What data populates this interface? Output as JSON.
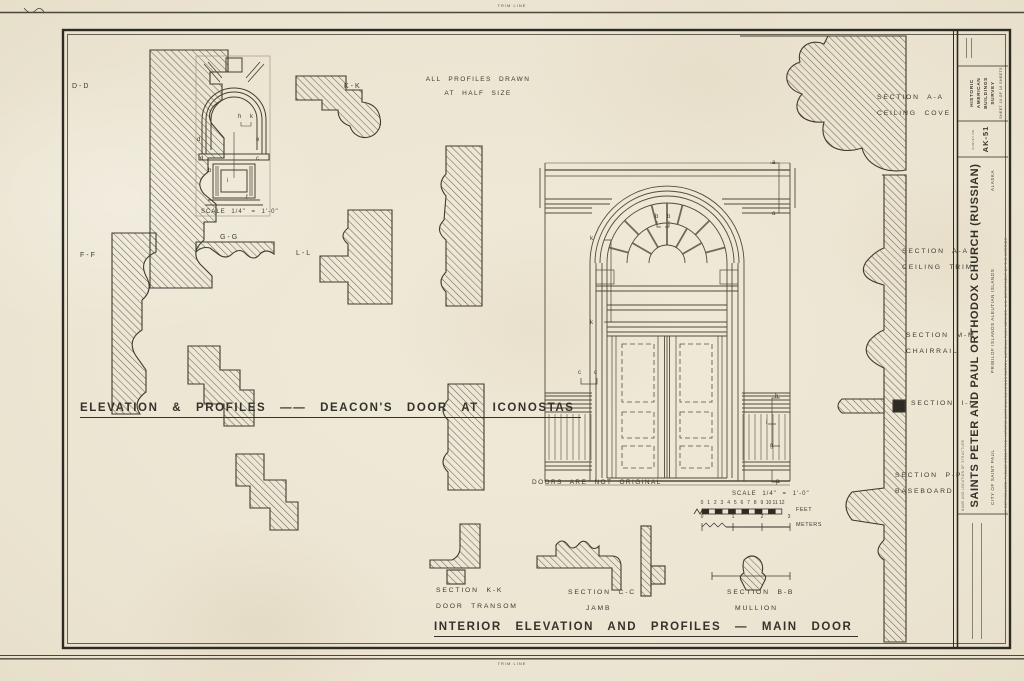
{
  "sheet": {
    "trim_line": "TRIM LINE"
  },
  "notes": {
    "profiles_note_1": "ALL PROFILES DRAWN",
    "profiles_note_2": "AT HALF SIZE",
    "doors_note": "DOORS ARE NOT ORIGINAL"
  },
  "profile_labels": {
    "dd": "D-D",
    "kk": "K-K",
    "ff": "F-F",
    "gg": "G-G",
    "ll": "L-L"
  },
  "titles": {
    "left": "ELEVATION & PROFILES —— DEACON'S DOOR AT ICONOSTAS",
    "main": "INTERIOR ELEVATION AND PROFILES — MAIN DOOR"
  },
  "scales": {
    "plan_scale": "SCALE  1/4\" = 1'-0\"",
    "main_scale": "SCALE  1/4\" = 1'-0\"",
    "feet_unit": "FEET",
    "meters_unit": "METERS",
    "feet_ticks": [
      "0",
      "1",
      "2",
      "3",
      "4",
      "5",
      "6",
      "7",
      "8",
      "9",
      "10",
      "11",
      "12"
    ],
    "meters_ticks": [
      {
        "label": "0",
        "x": 699
      },
      {
        "label": "1",
        "x": 730
      },
      {
        "label": "2",
        "x": 759
      },
      {
        "label": "3",
        "x": 786
      }
    ]
  },
  "sections": [
    {
      "line1": "SECTION  A-A",
      "line2": "CEILING  COVE"
    },
    {
      "line1": "SECTION  A-A",
      "line2": "CEILING  TRIM"
    },
    {
      "line1": "SECTION  M-M",
      "line2": "CHAIRRAIL"
    },
    {
      "line1": "SECTION  I-I",
      "line2": ""
    },
    {
      "line1": "SECTION  P-P",
      "line2": "BASEBOARD"
    },
    {
      "line1": "SECTION  K-K",
      "line2": "DOOR  TRANSOM"
    },
    {
      "line1": "SECTION  C-C",
      "line2": "JAMB"
    },
    {
      "line1": "SECTION  B-B",
      "line2": "MULLION"
    }
  ],
  "ref_letters": {
    "plan": [
      {
        "char": "h",
        "x": 238,
        "y": 114
      },
      {
        "char": "k",
        "x": 250,
        "y": 114
      },
      {
        "char": "d",
        "x": 197,
        "y": 137
      },
      {
        "char": "e",
        "x": 256,
        "y": 137
      },
      {
        "char": "d",
        "x": 200,
        "y": 156
      },
      {
        "char": "c",
        "x": 256,
        "y": 156
      },
      {
        "char": "b",
        "x": 208,
        "y": 168
      },
      {
        "char": "i",
        "x": 227,
        "y": 178
      },
      {
        "char": "f",
        "x": 246,
        "y": 195
      }
    ],
    "elevation": [
      {
        "char": "a",
        "x": 772,
        "y": 160
      },
      {
        "char": "a",
        "x": 772,
        "y": 211
      },
      {
        "char": "b",
        "x": 655,
        "y": 214
      },
      {
        "char": "b",
        "x": 667,
        "y": 214
      },
      {
        "char": "k",
        "x": 590,
        "y": 236
      },
      {
        "char": "k",
        "x": 590,
        "y": 320
      },
      {
        "char": "c",
        "x": 578,
        "y": 370
      },
      {
        "char": "c",
        "x": 594,
        "y": 370
      },
      {
        "char": "h",
        "x": 775,
        "y": 394
      },
      {
        "char": "i",
        "x": 766,
        "y": 420
      },
      {
        "char": "g",
        "x": 770,
        "y": 443
      },
      {
        "char": "p",
        "x": 776,
        "y": 479
      }
    ]
  },
  "title_block": {
    "survey_title_l1": "HISTORIC AMERICAN",
    "survey_title_l2": "BUILDINGS SURVEY",
    "survey_sheet": "SHEET 10 OF 10 SHEETS",
    "survey_no_label": "SURVEY NO.",
    "survey_no": "AK-51",
    "name_label": "NAME AND LOCATION OF STRUCTURE",
    "structure_name": "SAINTS PETER AND PAUL ORTHODOX CHURCH (RUSSIAN)",
    "structure_loc": "PRIBILOF ISLANDS    ALEUTIAN ISLANDS",
    "structure_state": "ALASKA",
    "structure_city": "CITY OF SAINT PAUL",
    "credit_line": "IF REPRODUCED, PLEASE CREDIT THE HISTORIC AMERICAN BUILDINGS SURVEY, NATIONAL PARK SERVICE, U.S. DEPARTMENT OF THE INTERIOR"
  }
}
